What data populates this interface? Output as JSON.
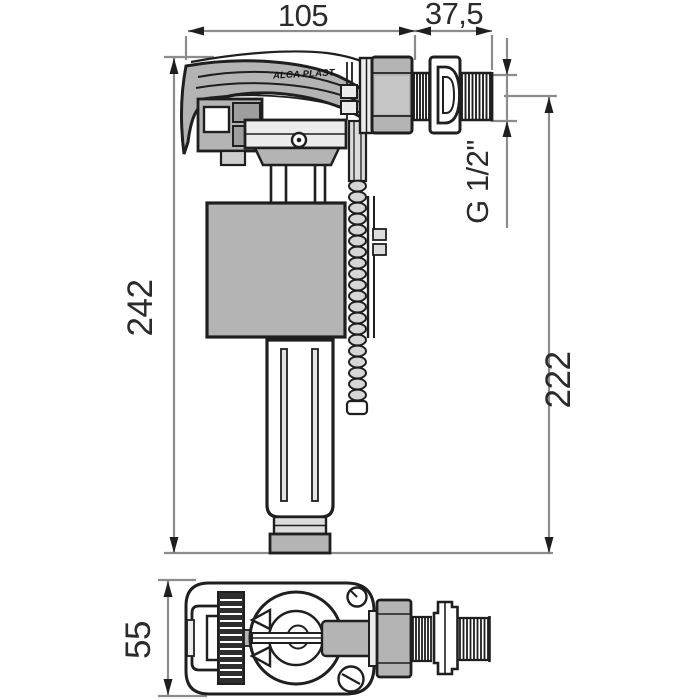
{
  "drawing": {
    "brand_label": "ALCA PLAST",
    "dimensions": {
      "top_width": "105",
      "shank_length": "37,5",
      "thread_spec": "G 1/2\"",
      "overall_height": "242",
      "install_height": "222",
      "body_depth": "55"
    }
  },
  "colors": {
    "line": "#1f1f1f",
    "part_gray": "#b4b4b4",
    "light_gray": "#dcdcdc",
    "dim_line": "#8c8c8c",
    "dim_text": "#2b2b2b",
    "background": "#ffffff"
  }
}
